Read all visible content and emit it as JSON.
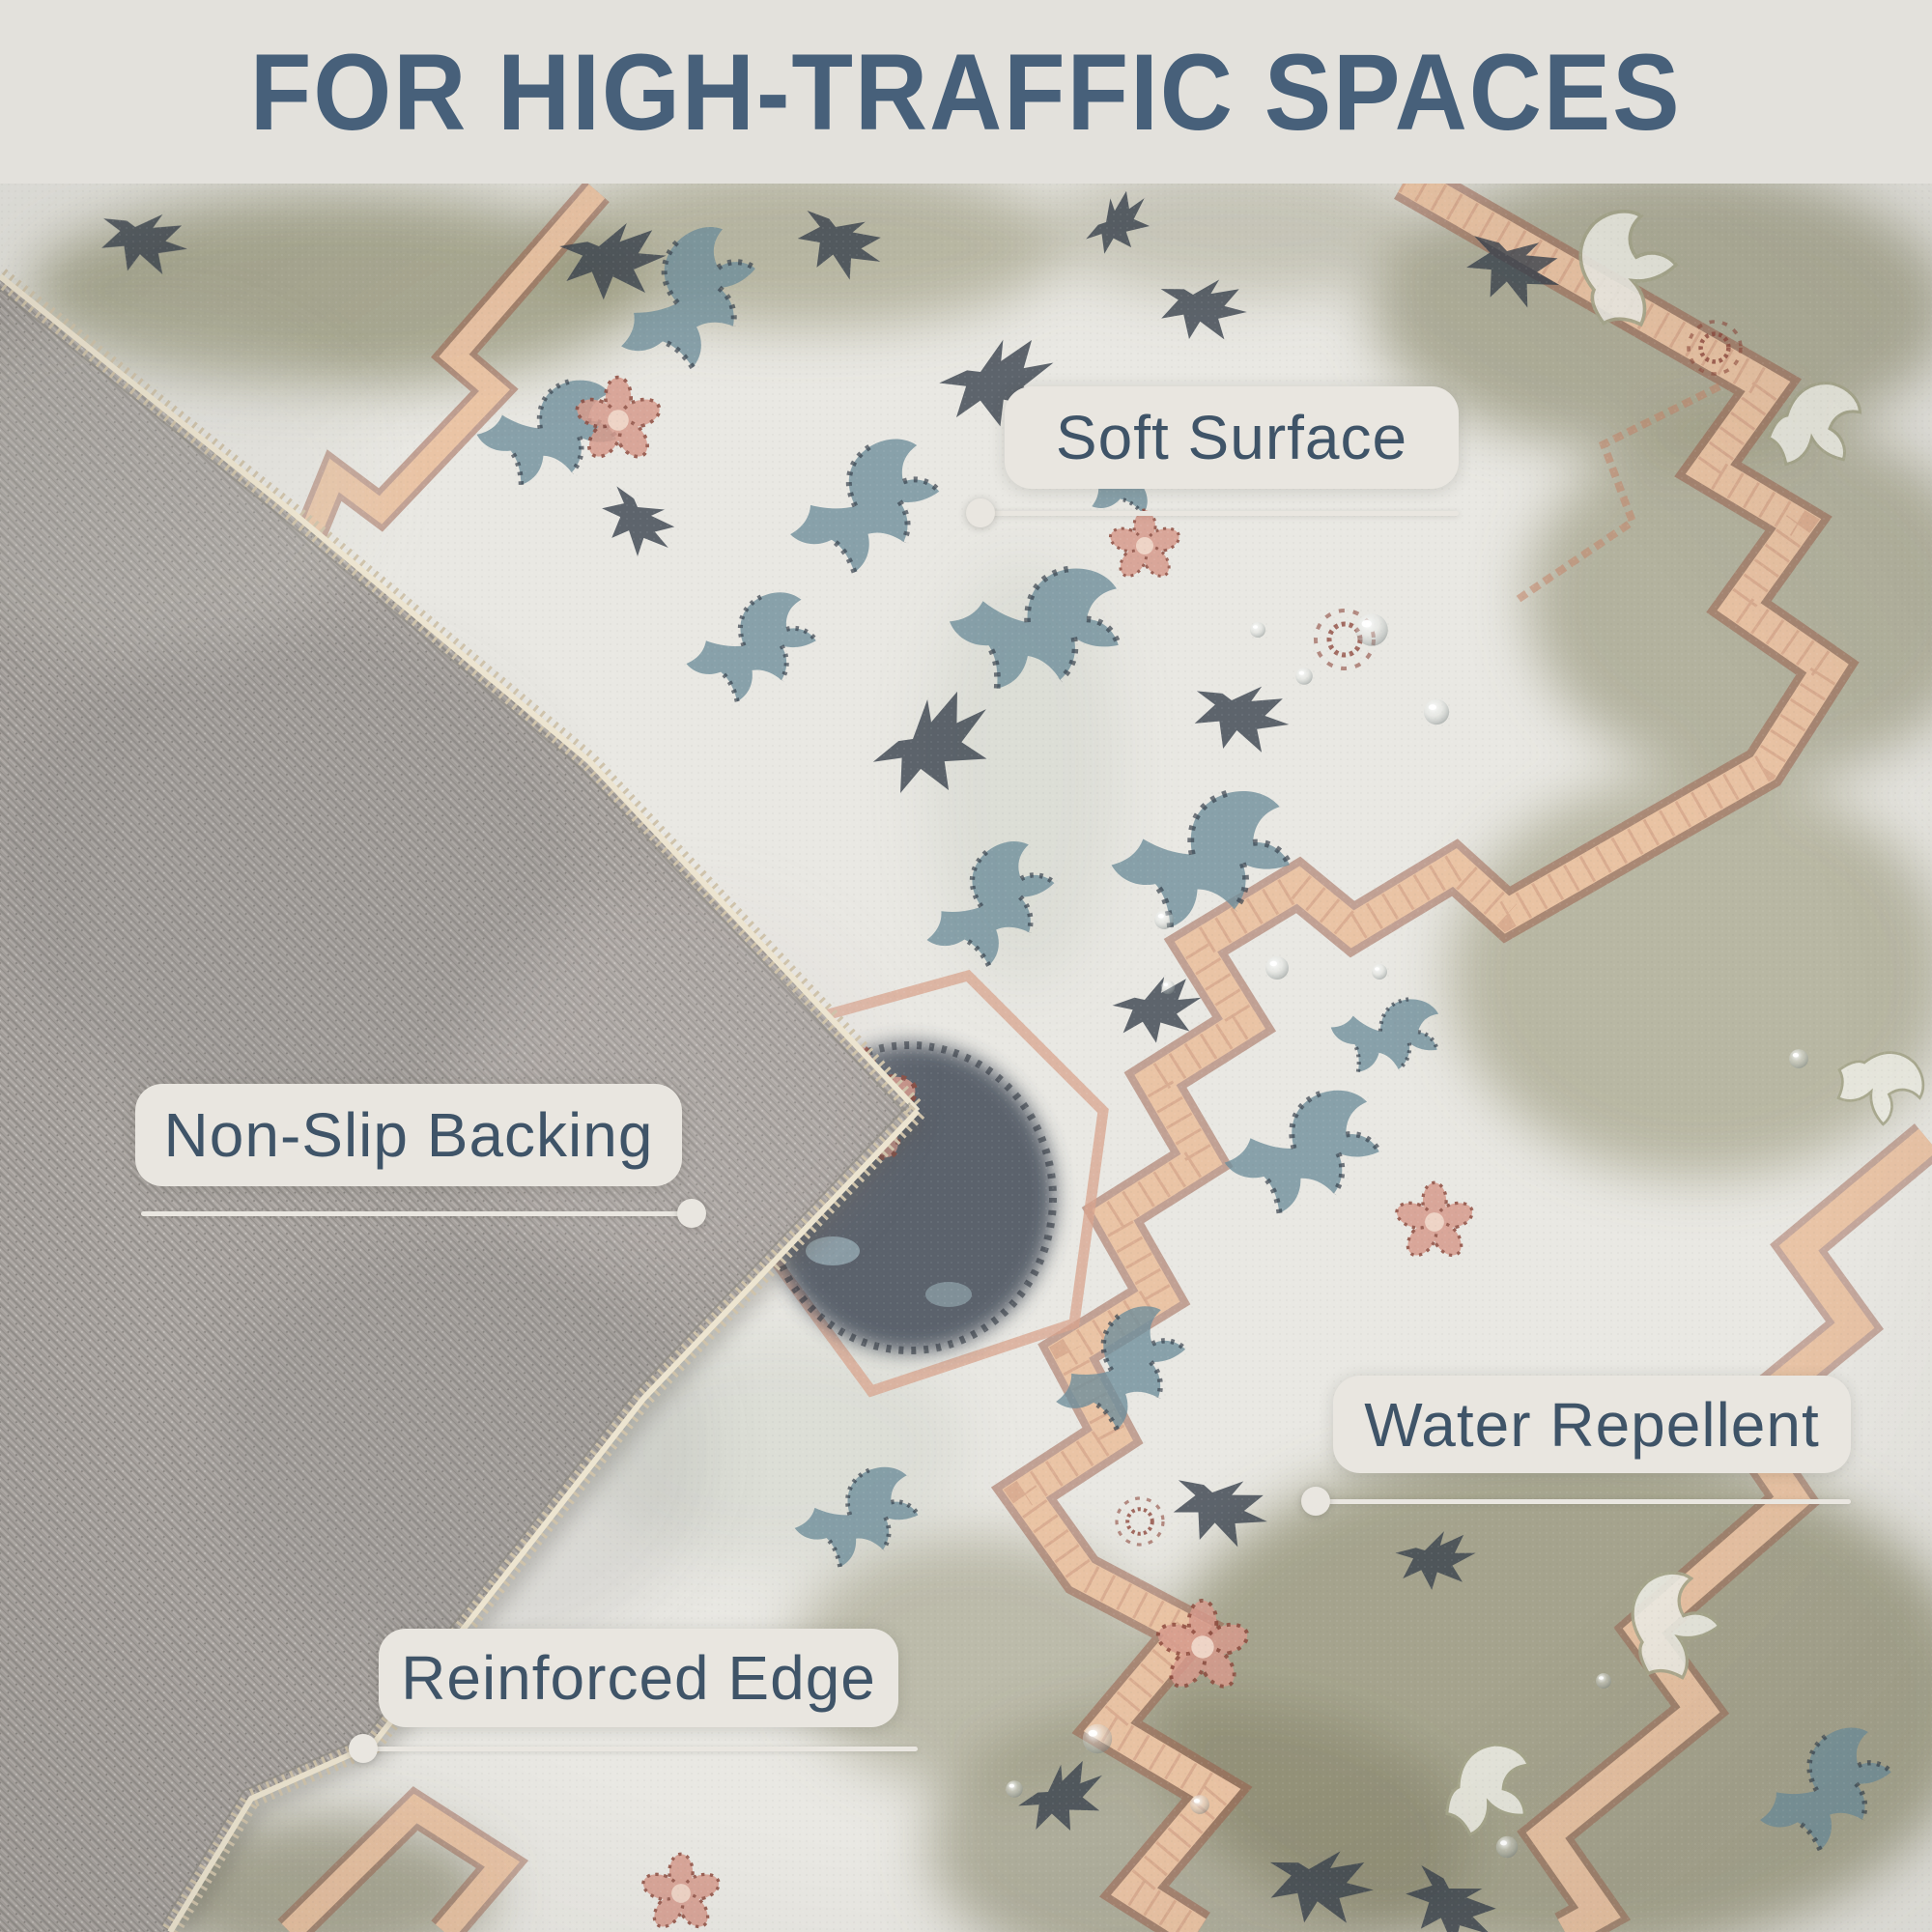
{
  "header": {
    "title": "FOR HIGH-TRAFFIC SPACES"
  },
  "callouts": [
    {
      "id": "soft-surface",
      "label": "Soft Surface"
    },
    {
      "id": "non-slip-backing",
      "label": "Non-Slip Backing"
    },
    {
      "id": "water-repellent",
      "label": "Water Repellent"
    },
    {
      "id": "reinforced-edge",
      "label": "Reinforced Edge"
    }
  ],
  "photo": {
    "description": "Vintage floral rug with corner folded over showing gray woven non-slip backing and stitched reinforced edge; water droplets on pile",
    "colors": {
      "header_bg": "#e3e1dc",
      "title_text": "#47607a",
      "badge_bg": "#e9e6e0",
      "badge_text": "#3f5468",
      "rug_field": "#e9e8e3",
      "rug_olive": "#8f8e70",
      "rug_salmon_border": "#ecc6a6",
      "rug_dark_red": "#8e4a3e",
      "rug_blue_motif": "#6f8e9b",
      "rug_navy_motif": "#3a424e",
      "backing_gray": "#a7a29e",
      "stitch_tan": "#cfc3ab"
    }
  }
}
